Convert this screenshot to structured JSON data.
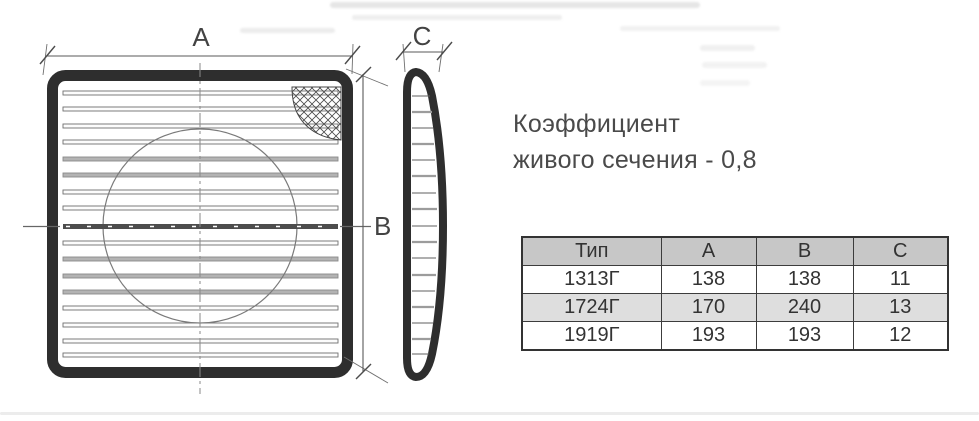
{
  "drawing": {
    "labels": {
      "a": "A",
      "b": "B",
      "c": "C"
    }
  },
  "caption": {
    "line1": "Коэффициент",
    "line2": "живого сечения - 0,8"
  },
  "spec_table": {
    "headers": [
      "Тип",
      "A",
      "B",
      "C"
    ],
    "rows": [
      [
        "1313Г",
        "138",
        "138",
        "11"
      ],
      [
        "1724Г",
        "170",
        "240",
        "13"
      ],
      [
        "1919Г",
        "193",
        "193",
        "12"
      ]
    ]
  },
  "colors": {
    "outline_dark": "#2e2e2e",
    "dim_line": "#5a5a5a",
    "text": "#4a4a4a",
    "table_header_bg": "#c7c7c7",
    "table_alt_row_bg": "#dedede",
    "table_border": "#333333"
  }
}
